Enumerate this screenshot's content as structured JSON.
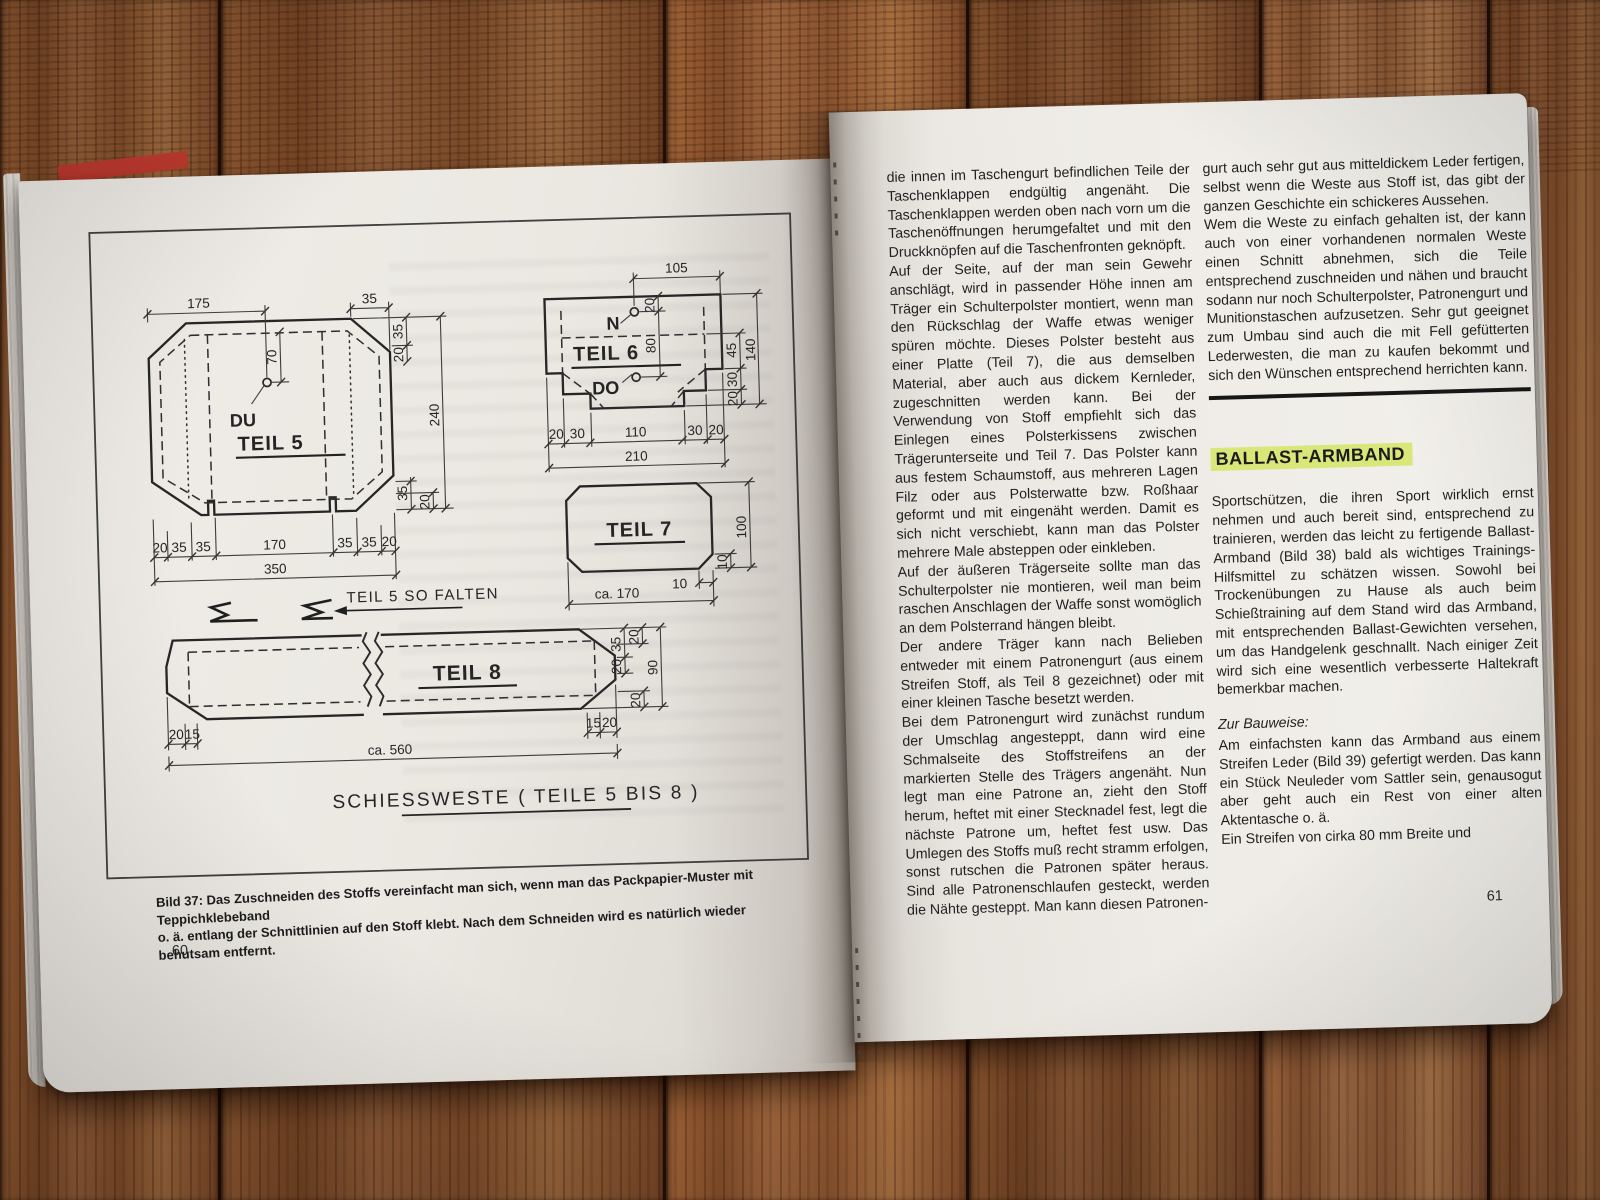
{
  "colors": {
    "paper": "#ece9e3",
    "ink": "#1f1f1f",
    "heading_highlight": "#d9e77a",
    "wood": "#8a5530",
    "rule": "#171717",
    "red_cover": "#bf3a2e"
  },
  "left_page": {
    "page_number": "60",
    "caption_line1": "Bild 37: Das Zuschneiden des Stoffs vereinfacht man sich, wenn man das Packpapier-Muster mit Teppichklebeband",
    "caption_line2": "o. ä. entlang der Schnittlinien auf den Stoff klebt. Nach dem Schneiden wird es natürlich wieder behutsam entfernt.",
    "diagram": {
      "drawing_title": "SCHIESSWESTE ( TEILE  5 BIS 8 )",
      "fold_note": "TEIL 5  SO FALTEN",
      "teil5": {
        "title": "TEIL 5",
        "hole_label": "DU",
        "dim_top_left": "175",
        "dim_top_right": "35",
        "dim_right_top": [
          "35",
          "20"
        ],
        "dim_hole": "70",
        "dim_height": "240",
        "dim_right_bottom": [
          "35",
          "20"
        ],
        "dim_bottom": [
          "20",
          "35",
          "35",
          "170",
          "35",
          "35",
          "20"
        ],
        "dim_bottom_total": "350"
      },
      "teil6": {
        "title": "TEIL 6",
        "hole_top_label": "N",
        "hole_bottom_label": "DO",
        "dim_top": "105",
        "dim_hole_top": "20",
        "dim_holes": "80",
        "dim_right": [
          "45",
          "30",
          "20"
        ],
        "dim_right_total": "140",
        "dim_bottom": [
          "20",
          "30",
          "110",
          "30",
          "20"
        ],
        "dim_bottom_total": "210"
      },
      "teil7": {
        "title": "TEIL 7",
        "dim_height": "100",
        "dim_corner_v": "10",
        "dim_corner_h": "10",
        "dim_width": "ca.  170"
      },
      "teil8": {
        "title": "TEIL 8",
        "dim_left": [
          "20",
          "15"
        ],
        "dim_right": [
          "15",
          "20"
        ],
        "dim_total": "ca. 560",
        "dim_side_inner": [
          "35",
          "20"
        ],
        "dim_side_outer": [
          "20",
          "90",
          "20"
        ]
      }
    }
  },
  "right_page": {
    "page_number": "61",
    "column1": {
      "paragraphs": [
        "die innen im Taschengurt befindlichen Teile der Taschenklappen endgültig angenäht. Die Taschenklappen werden oben nach vorn um die Taschenöffnungen herumgefaltet und mit den Druckknöpfen auf die Taschenfronten geknöpft.",
        "Auf der Seite, auf der man sein Gewehr anschlägt, wird in passender Höhe innen am Träger ein Schulterpolster montiert, wenn man den Rückschlag der Waffe etwas weniger spüren möchte. Dieses Polster besteht aus einer Platte (Teil 7), die aus demselben Material, aber auch aus dickem Kernleder, zugeschnitten werden kann. Bei der Verwendung von Stoff empfiehlt sich das Einlegen eines Polsterkissens zwischen Trägerunterseite und Teil 7. Das Polster kann aus festem Schaumstoff, aus mehreren Lagen Filz oder aus Polsterwatte bzw. Roßhaar geformt und mit eingenäht werden. Damit es sich nicht verschiebt, kann man das Polster mehrere Male absteppen oder einkleben.",
        "Auf der äußeren Trägerseite sollte man das Schulterpolster nie montieren, weil man beim raschen Anschlagen der Waffe sonst womöglich an dem Polsterrand hängen bleibt.",
        "Der andere Träger kann nach Belieben entweder mit einem Patronengurt (aus einem Streifen Stoff, als Teil 8 gezeichnet) oder mit einer kleinen Tasche besetzt werden.",
        "Bei dem Patronengurt wird zunächst rundum der Umschlag angesteppt, dann wird eine Schmalseite des Stoffstreifens an der markierten Stelle des Trägers angenäht. Nun legt man eine Patrone an, zieht den Stoff herum, heftet mit einer Stecknadel fest, legt die nächste Patrone um, heftet fest usw. Das Umlegen des Stoffs muß recht stramm erfolgen, sonst rutschen die Patronen später heraus. Sind alle Patronenschlaufen gesteckt, werden die Nähte gesteppt. Man kann diesen Patronen-"
      ]
    },
    "column2": {
      "paragraph1": "gurt auch sehr gut aus mitteldickem Leder fertigen, selbst wenn die Weste aus Stoff ist, das gibt der ganzen Geschichte ein schickeres Aussehen.",
      "paragraph2": "Wem die Weste zu einfach gehalten ist, der kann auch von einer vorhandenen normalen Weste einen Schnitt abnehmen, sich die Teile entsprechend zuschneiden und nähen und braucht sodann nur noch Schulterpolster, Patronengurt und Munitionstaschen aufzusetzen. Sehr gut geeignet zum Umbau sind auch die mit Fell gefütterten Lederwesten, die man zu kaufen bekommt und sich den Wünschen entsprechend herrichten kann.",
      "heading": "BALLAST-ARMBAND",
      "paragraph3": "Sportschützen, die ihren Sport wirklich ernst nehmen und auch bereit sind, entsprechend zu trainieren, werden das leicht zu fertigende Ballast-Armband (Bild 38) bald als wichtiges Trainings-Hilfsmittel zu schätzen wissen. Sowohl bei Trockenübungen zu Hause als auch beim Schießtraining auf dem Stand wird das Armband, mit entsprechenden Ballast-Gewichten versehen, um das Handgelenk geschnallt. Nach einiger Zeit wird sich eine wesentlich verbesserte Haltekraft bemerkbar machen.",
      "subheading": "Zur Bauweise:",
      "paragraph4": "Am einfachsten kann das Armband aus einem Streifen Leder (Bild 39) gefertigt werden. Das kann ein Stück Neuleder vom Sattler sein, genausogut aber geht auch ein Rest von einer alten Aktentasche o. ä.",
      "paragraph5": "Ein Streifen von cirka 80 mm Breite und"
    }
  }
}
